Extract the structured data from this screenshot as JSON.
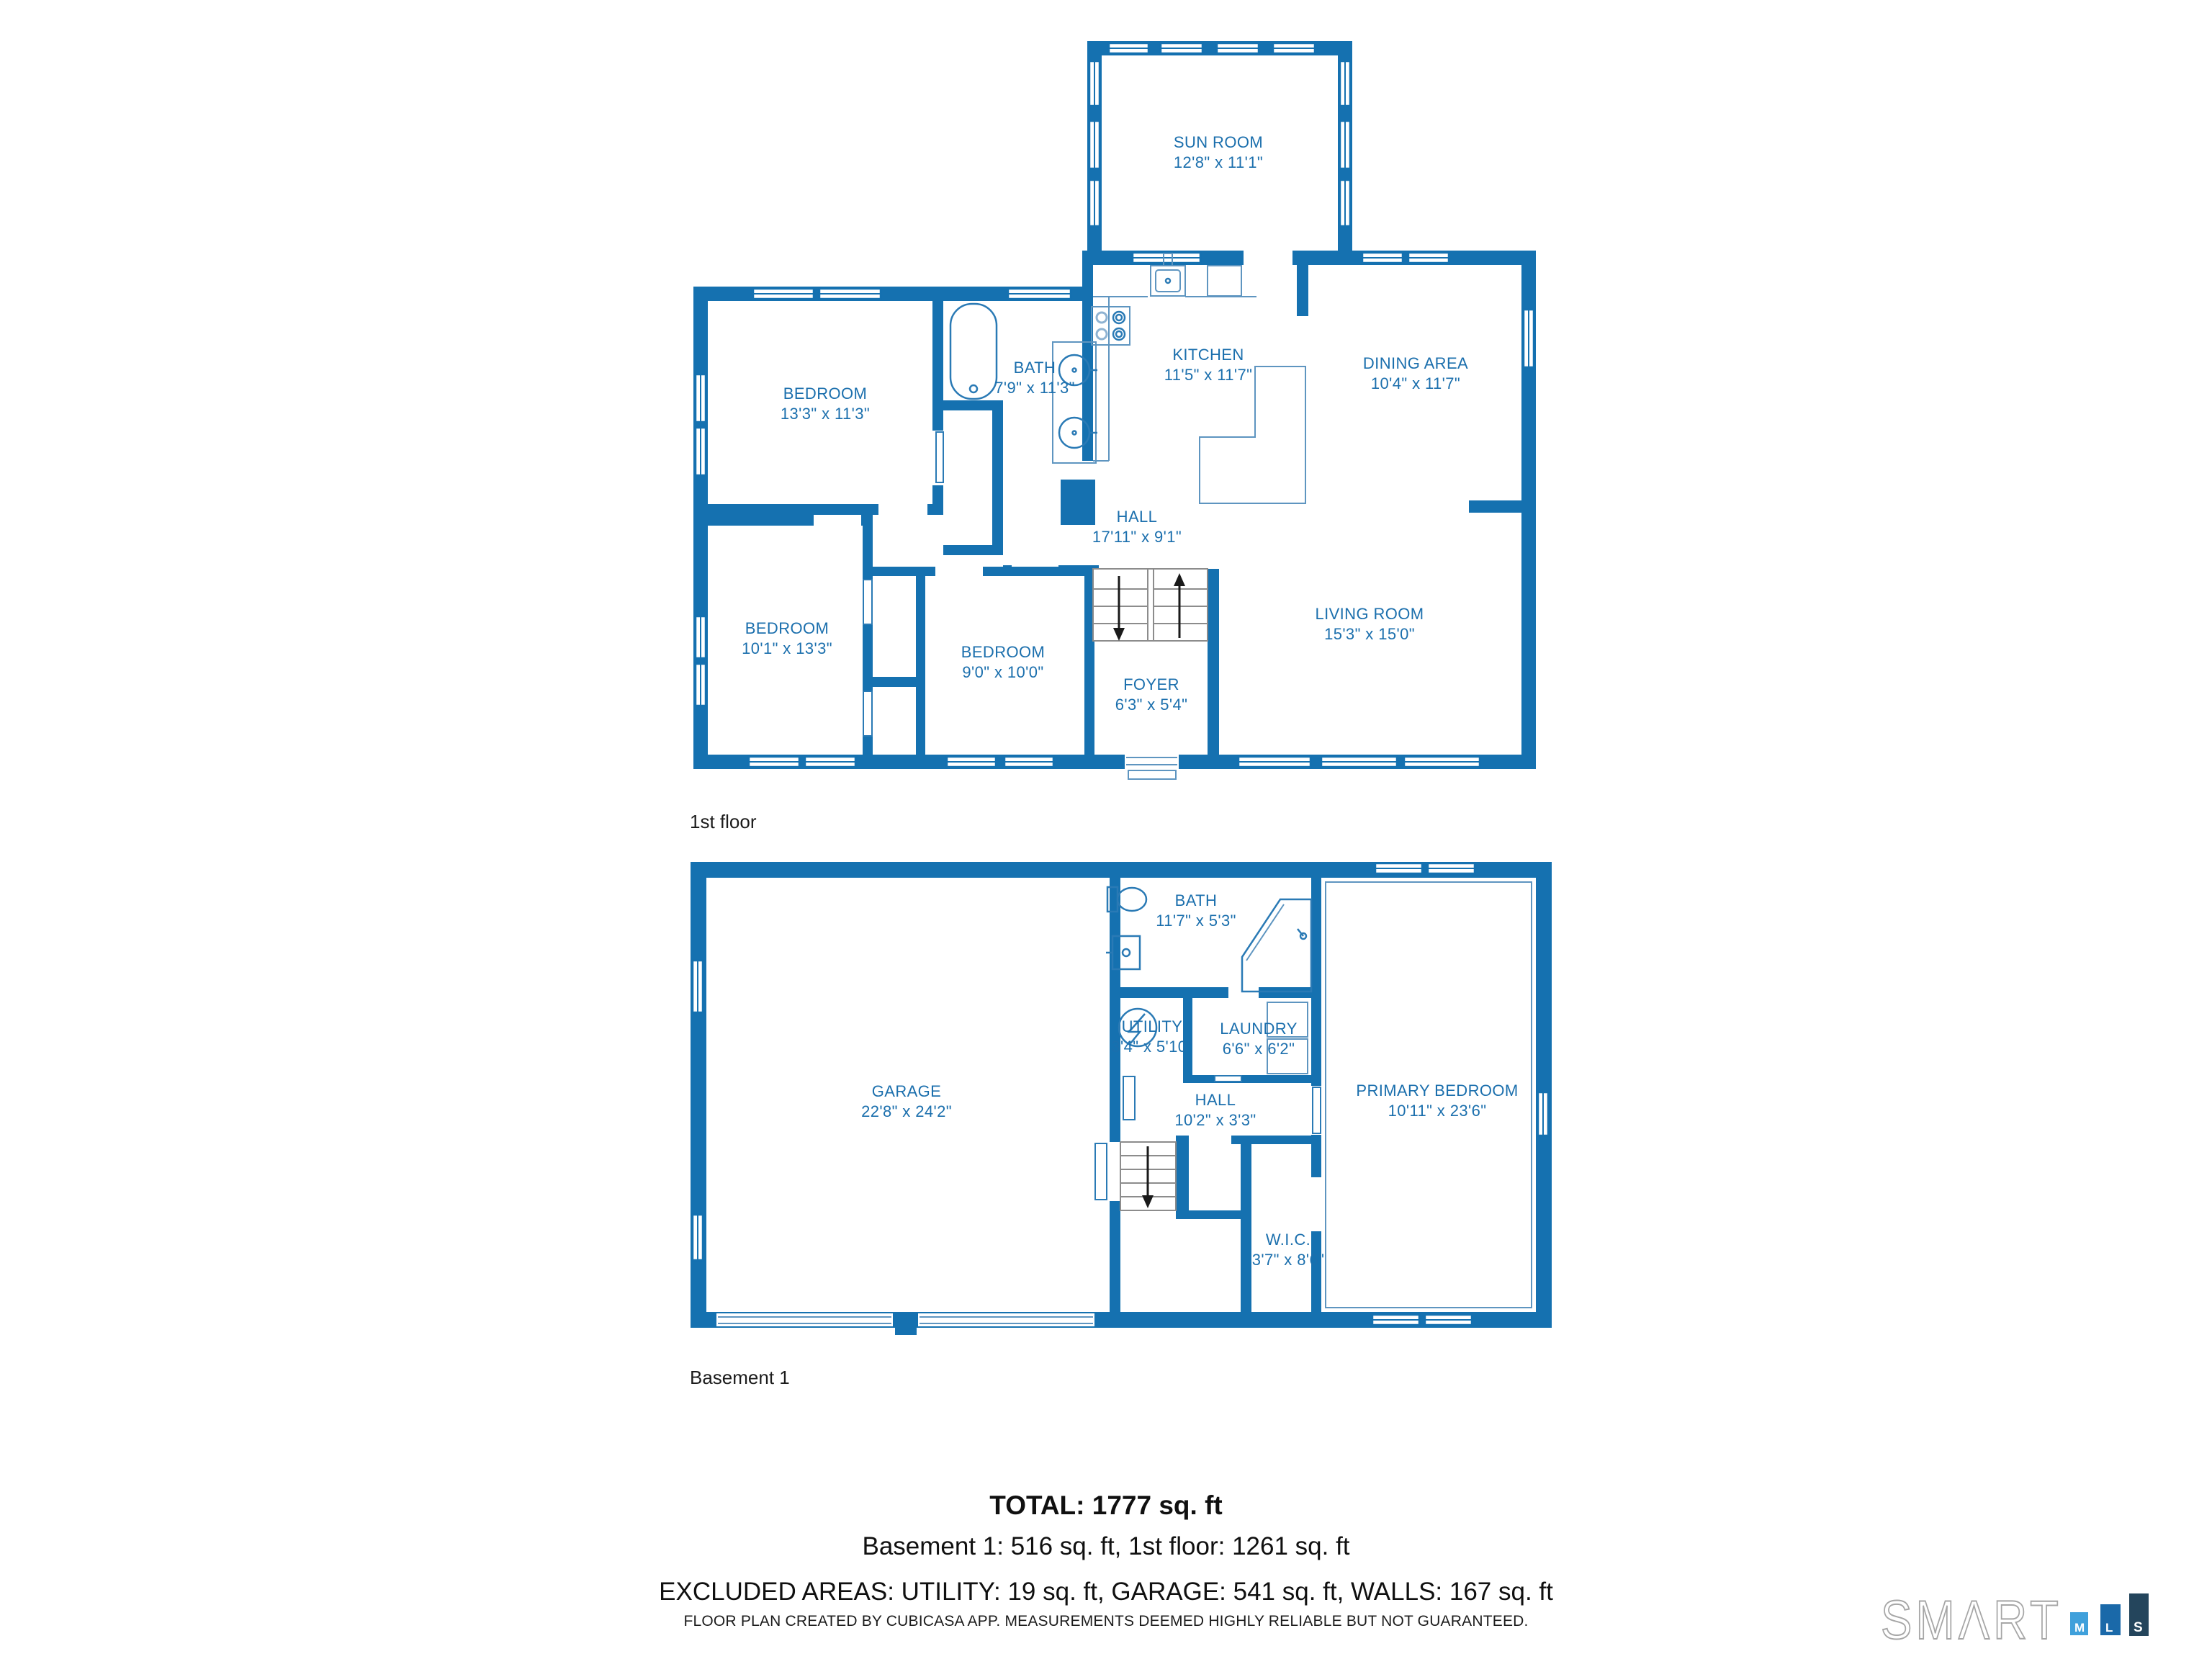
{
  "colors": {
    "wall_blue": "#1571B0",
    "label_blue": "#1B6FAD",
    "text_dark": "#1a1a1a",
    "logo_m_square": "#3FA0DB",
    "logo_l_square": "#1A69A9",
    "logo_s_square": "#24455C",
    "logo_outline_gray": "#A6A6A6"
  },
  "floors": {
    "first": {
      "label": "1st floor",
      "rooms": {
        "sun_room": {
          "name": "SUN ROOM",
          "dims": "12'8\" x 11'1\""
        },
        "bedroom_a": {
          "name": "BEDROOM",
          "dims": "13'3\" x 11'3\""
        },
        "bath": {
          "name": "BATH",
          "dims": "7'9\" x 11'3\""
        },
        "kitchen": {
          "name": "KITCHEN",
          "dims": "11'5\" x 11'7\""
        },
        "dining": {
          "name": "DINING AREA",
          "dims": "10'4\" x 11'7\""
        },
        "hall": {
          "name": "HALL",
          "dims": "17'11\" x 9'1\""
        },
        "bedroom_b": {
          "name": "BEDROOM",
          "dims": "10'1\" x 13'3\""
        },
        "bedroom_c": {
          "name": "BEDROOM",
          "dims": "9'0\" x 10'0\""
        },
        "foyer": {
          "name": "FOYER",
          "dims": "6'3\" x 5'4\""
        },
        "living": {
          "name": "LIVING ROOM",
          "dims": "15'3\" x 15'0\""
        }
      }
    },
    "basement": {
      "label": "Basement 1",
      "rooms": {
        "garage": {
          "name": "GARAGE",
          "dims": "22'8\" x 24'2\""
        },
        "bath": {
          "name": "BATH",
          "dims": "11'7\" x 5'3\""
        },
        "utility": {
          "name": "UTILITY",
          "dims": "3'4\" x 5'10\""
        },
        "laundry": {
          "name": "LAUNDRY",
          "dims": "6'6\" x 6'2\""
        },
        "hall": {
          "name": "HALL",
          "dims": "10'2\" x 3'3\""
        },
        "wic": {
          "name": "W.I.C.",
          "dims": "3'7\" x 8'6\""
        },
        "primary": {
          "name": "PRIMARY BEDROOM",
          "dims": "10'11\" x 23'6\""
        }
      }
    }
  },
  "summary": {
    "total": "TOTAL: 1777 sq. ft",
    "breakdown": "Basement 1: 516 sq. ft, 1st floor: 1261 sq. ft",
    "excluded": "EXCLUDED AREAS: UTILITY: 19 sq. ft, GARAGE: 541 sq. ft, WALLS: 167 sq. ft"
  },
  "footer": {
    "disclaimer": "FLOOR PLAN CREATED BY CUBICASA APP. MEASUREMENTS DEEMED HIGHLY RELIABLE BUT NOT GUARANTEED."
  },
  "logo": {
    "wordmark": "SMΛRT",
    "squares": [
      "M",
      "L",
      "S"
    ]
  }
}
